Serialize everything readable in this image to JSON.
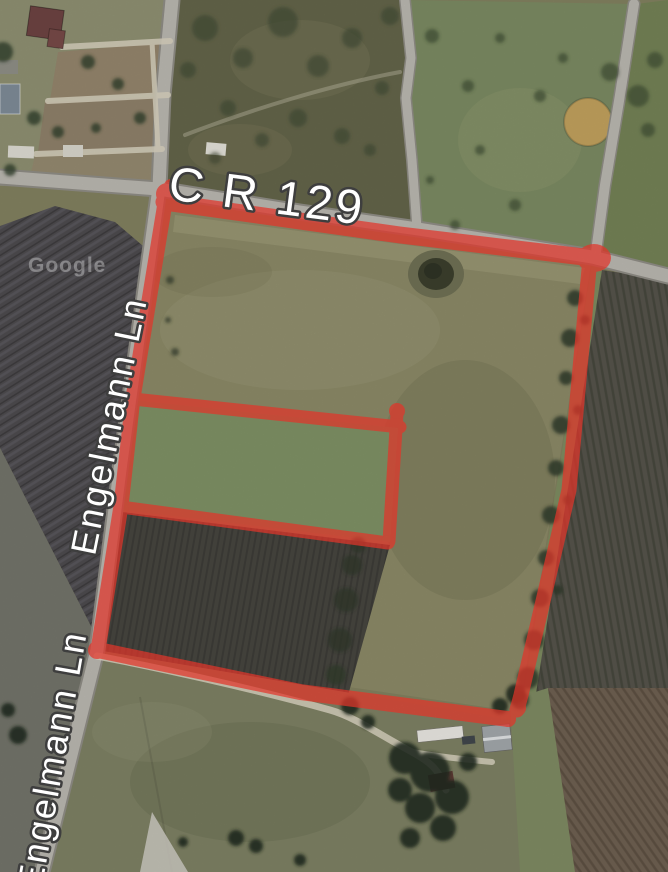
{
  "map": {
    "view": "satellite",
    "labels": {
      "road_main": "C R 129",
      "road_side": "Engelmann Ln",
      "road_side_2": "Engelmann Ln",
      "watermark": "Google"
    },
    "colors": {
      "boundary_red": "#e2352a",
      "road_fill": "#bab7b0",
      "road_casing": "#8f8c85",
      "path_dirt": "#d8d2bf",
      "label_fill": "#ffffff",
      "label_outline": "#3e3e3e",
      "field_parcel": "#8b8967",
      "field_inner_green": "#7e9165",
      "field_inner_plowed": "#46453f",
      "field_left_plowed": "#4d4b4e",
      "field_east_rows": "#56534b",
      "field_bottom_right": "#6e6051",
      "pond_dark": "#3c3f2d"
    },
    "overlay": {
      "type": "parcel-boundary",
      "outer_corners": [
        [
          166,
          198
        ],
        [
          592,
          258
        ],
        [
          519,
          712
        ],
        [
          97,
          650
        ]
      ],
      "inner_lines": 3
    }
  }
}
